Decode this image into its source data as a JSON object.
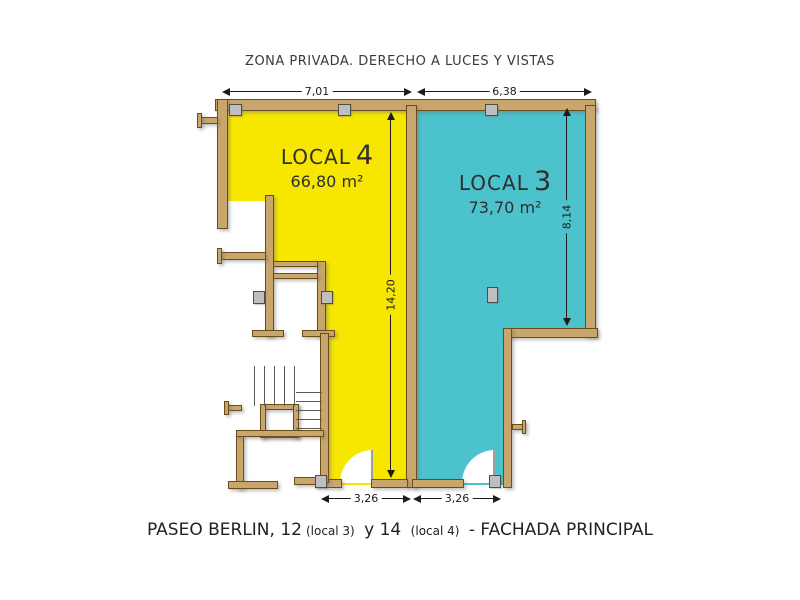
{
  "title": "ZONA PRIVADA. DERECHO A LUCES Y VISTAS",
  "plan": {
    "local4": {
      "label": "LOCAL",
      "number": "4",
      "area": "66,80 m²",
      "fill": "#f7e600"
    },
    "local3": {
      "label": "LOCAL",
      "number": "3",
      "area": "73,70 m²",
      "fill": "#4cc3cc"
    },
    "wall_color": "#c9a66b",
    "dims": {
      "width_local4": "7,01",
      "width_local3": "6,38",
      "depth_local4": "14,20",
      "depth_local3": "8,14",
      "door_width_local4": "3,26",
      "door_width_local3": "3,26"
    }
  },
  "caption": {
    "part1": "PASEO BERLIN, 12",
    "part2": "(local 3)",
    "part3": "y 14",
    "part4": "(local 4)",
    "part5": "- FACHADA PRINCIPAL"
  }
}
